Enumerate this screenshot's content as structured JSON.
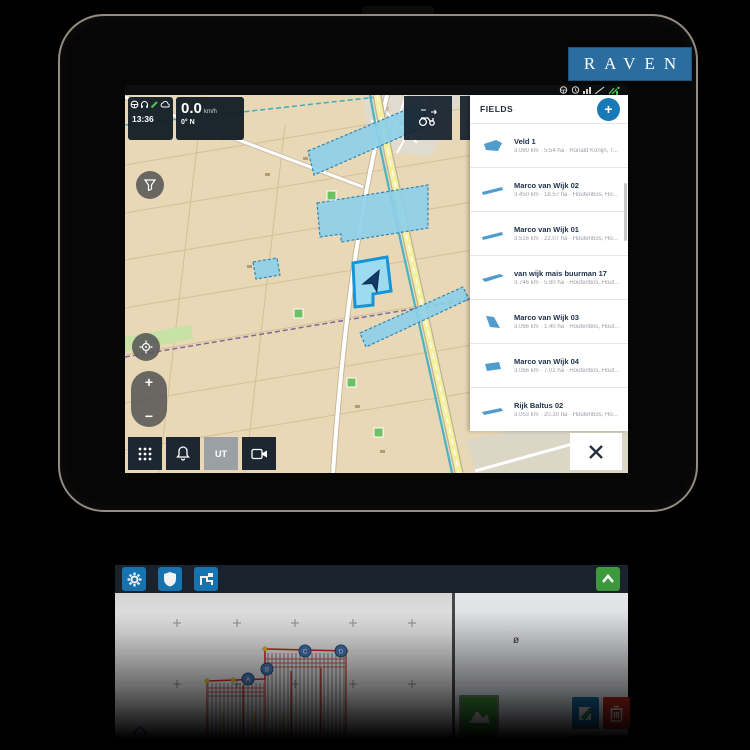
{
  "device": {
    "brand_logo": "RAVEN"
  },
  "statusbar": {
    "icons": [
      "steering-wheel",
      "alert-clock",
      "signal-bars",
      "antenna",
      "satellite-green"
    ]
  },
  "hud": {
    "time": "13:36",
    "speed": "0.0",
    "speed_unit": "km/h",
    "heading": "0° N",
    "machine_icons": [
      "steering-wheel",
      "headset",
      "pencil-green",
      "cloud"
    ]
  },
  "fields_panel": {
    "title": "FIELDS",
    "add_label": "+",
    "items": [
      {
        "title": "Veld 1",
        "subtitle": "3.080 km · 5.54 ha · Ronald Konijn, T..."
      },
      {
        "title": "Marco van Wijk 02",
        "subtitle": "3.450 km · 18.57 ha · Houtenbos, Ho..."
      },
      {
        "title": "Marco van Wijk 01",
        "subtitle": "3.516 km · 22.07 ha · Houtenbos, Ho..."
      },
      {
        "title": "van wijk mais buurman 17",
        "subtitle": "3.746 km · 5.80 ha · Houtenbos, Hout..."
      },
      {
        "title": "Marco van Wijk 03",
        "subtitle": "3.066 km · 1.40 ha · Houtenbos, Hout..."
      },
      {
        "title": "Marco van Wijk 04",
        "subtitle": "3.066 km · 7.02 ha · Houtenbos, Hout..."
      },
      {
        "title": "Rijk Baltus 02",
        "subtitle": "3.053 km · 20.30 ha · Houtenbos, Ho..."
      }
    ]
  },
  "bottom_toolbar": {
    "ut_label": "UT"
  },
  "reflection": {
    "phi": "ø",
    "markers": [
      "A",
      "B",
      "C",
      "D"
    ]
  },
  "colors": {
    "accent": "#1779b8",
    "raven_blue": "#2a6d9e",
    "map_bg": "#e9d8b6",
    "field_fill": "#8ccfe9",
    "field_stroke": "#2e86b8",
    "road_yellow": "#f6efa0",
    "green_button": "#3fa03f",
    "delete_red": "#c42b1f",
    "boundary_red": "#d83025"
  }
}
